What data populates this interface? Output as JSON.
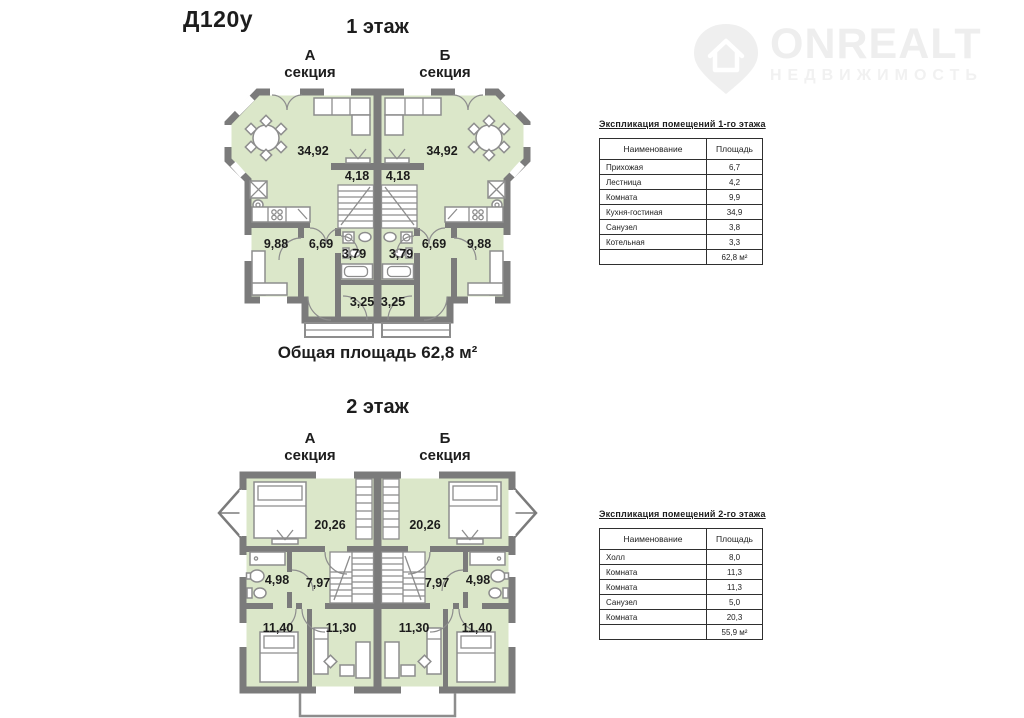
{
  "page": {
    "code": "Д120у"
  },
  "logo": {
    "name": "ONREALT",
    "subtitle": "НЕДВИЖИМОСТЬ"
  },
  "floor1": {
    "heading": "1 этаж",
    "section_a": {
      "letter": "А",
      "word": "секция"
    },
    "section_b": {
      "letter": "Б",
      "word": "секция"
    },
    "total_caption": "Общая площадь 62,8 м²",
    "areas": {
      "living": "34,92",
      "stairs": "4,18",
      "room": "9,88",
      "hall": "6,69",
      "bath": "3,79",
      "entry": "3,25"
    }
  },
  "floor2": {
    "heading": "2 этаж",
    "section_a": {
      "letter": "А",
      "word": "секция"
    },
    "section_b": {
      "letter": "Б",
      "word": "секция"
    },
    "areas": {
      "bedroom": "20,26",
      "bath": "4,98",
      "hall": "7,97",
      "bedroom_side": "11,40",
      "bedroom_mid": "11,30"
    }
  },
  "tables": {
    "floor1": {
      "title": "Экспликация помещений 1-го этажа",
      "col_name": "Наименование",
      "col_area": "Площадь",
      "rows": [
        {
          "name": "Прихожая",
          "area": "6,7"
        },
        {
          "name": "Лестница",
          "area": "4,2"
        },
        {
          "name": "Комната",
          "area": "9,9"
        },
        {
          "name": "Кухня-гостиная",
          "area": "34,9"
        },
        {
          "name": "Санузел",
          "area": "3,8"
        },
        {
          "name": "Котельная",
          "area": "3,3"
        }
      ],
      "total": "62,8 м²"
    },
    "floor2": {
      "title": "Экспликация помещений 2-го этажа",
      "col_name": "Наименование",
      "col_area": "Площадь",
      "rows": [
        {
          "name": "Холл",
          "area": "8,0"
        },
        {
          "name": "Комната",
          "area": "11,3"
        },
        {
          "name": "Комната",
          "area": "11,3"
        },
        {
          "name": "Санузел",
          "area": "5,0"
        },
        {
          "name": "Комната",
          "area": "20,3"
        }
      ],
      "total": "55,9 м²"
    }
  }
}
